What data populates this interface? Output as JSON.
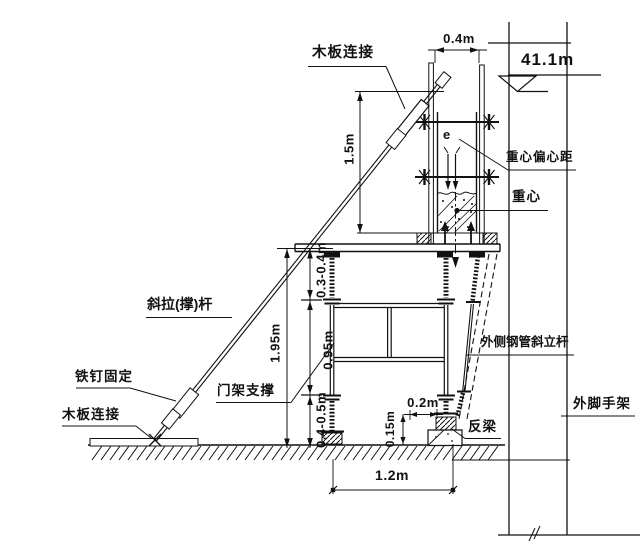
{
  "drawing": {
    "kind": "construction support detail drawing",
    "labels": {
      "board_connection_top": "木板连接",
      "elevation_mark": "41.1m",
      "eccentricity": "e",
      "gravity_center_offset": "重心偏心距",
      "gravity_center": "重心",
      "diagonal_brace": "斜拉(撑)杆",
      "nail_fix": "铁钉固定",
      "board_connection_bottom": "木板连接",
      "gate_frame_support": "门架支撑",
      "outer_steel_pipe_batter_post": "外侧钢管斜立杆",
      "outer_scaffold": "外脚手架",
      "counter_beam": "反梁"
    },
    "dimensions": {
      "top_width": "0.4m",
      "upper_height": "1.5m",
      "total_height": "1.95m",
      "top_clearance": "0.3-0.4m",
      "gate_frame_height": "0.95m",
      "bottom_clearance": "0.4-0.5m",
      "counter_beam_width": "0.2m",
      "counter_beam_height": "0.15m",
      "base_span": "1.2m"
    },
    "ink_color": "#111111",
    "background_color": "#ffffff"
  }
}
